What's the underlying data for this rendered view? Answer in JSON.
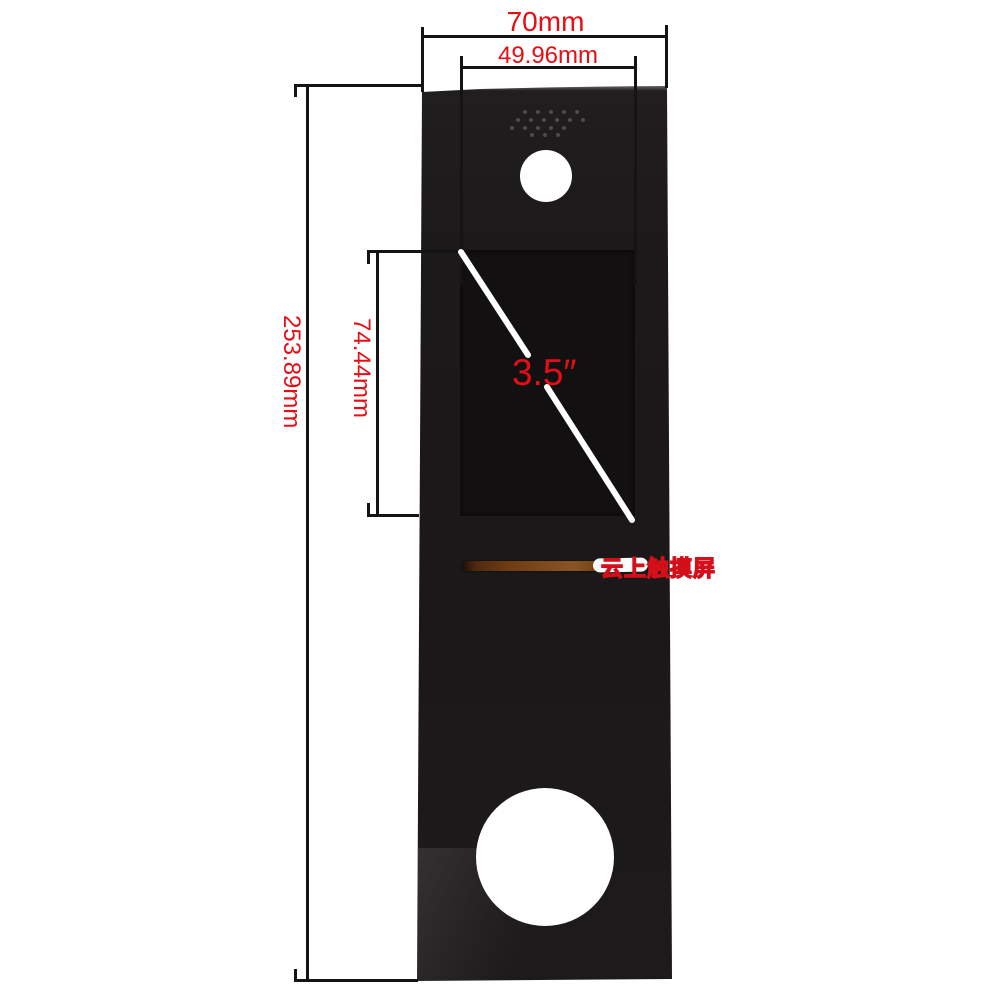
{
  "meta": {
    "description": "Product photo of a black 3.5 inch touch screen glass panel with red dimension annotations on white background"
  },
  "annotations": {
    "overall_width_label": "70mm",
    "inner_width_label": "49.96mm",
    "overall_height_label": "253.89mm",
    "screen_height_label": "74.44mm",
    "screen_diagonal_label": "3.5″",
    "watermark_text": "云上触摸屏"
  },
  "colors": {
    "annotation_red": "#e50e14",
    "panel_black": "#1c191a",
    "screen_black": "#131011",
    "background_white": "#ffffff",
    "dimension_line_black": "#141414",
    "flex_cable_brown": "#7c481c"
  }
}
